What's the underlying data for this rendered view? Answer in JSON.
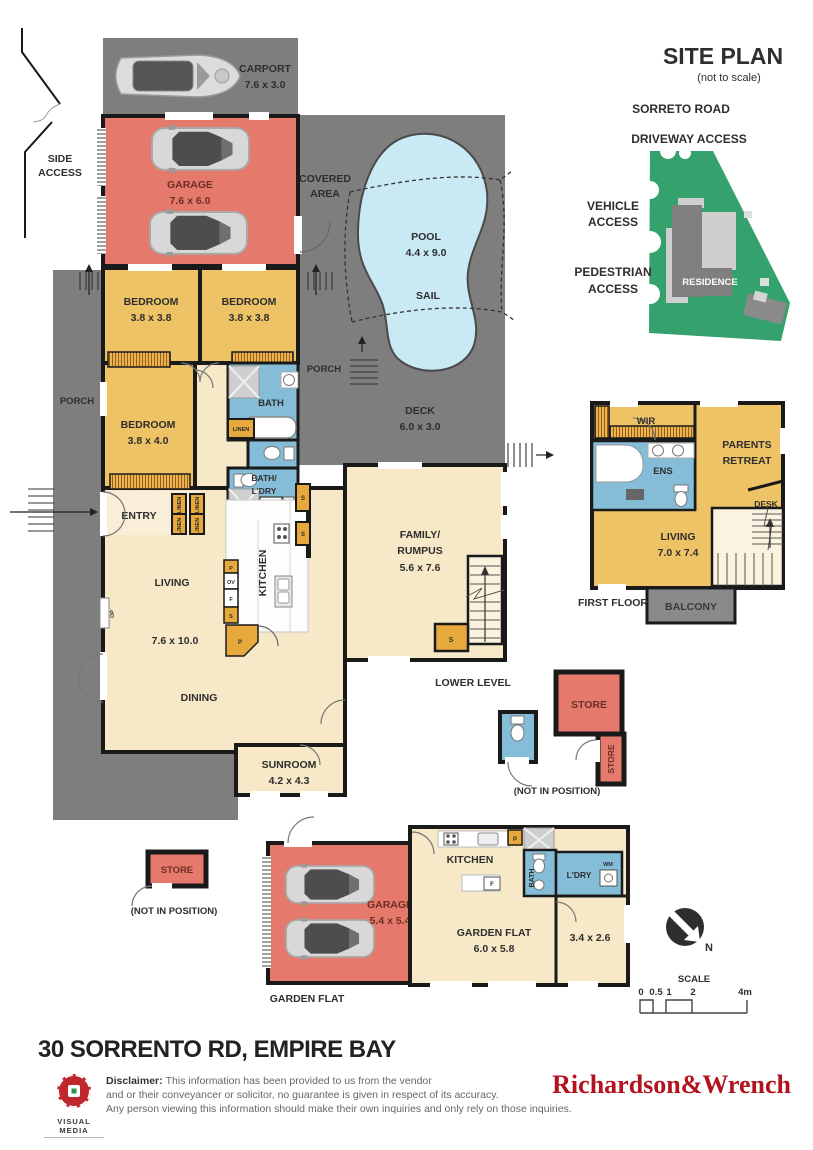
{
  "site_plan": {
    "title": "SITE PLAN",
    "subtitle": "(not to scale)",
    "road": "SORRETO ROAD",
    "driveway": "DRIVEWAY ACCESS",
    "vehicle_line1": "VEHICLE",
    "vehicle_line2": "ACCESS",
    "pedestrian_line1": "PEDESTRIAN",
    "pedestrian_line2": "ACCESS",
    "residence": "RESIDENCE"
  },
  "ground": {
    "side_access_line1": "SIDE",
    "side_access_line2": "ACCESS",
    "carport": "CARPORT",
    "carport_dims": "7.6 x 3.0",
    "garage": "GARAGE",
    "garage_dims": "7.6 x 6.0",
    "covered_line1": "COVERED",
    "covered_line2": "AREA",
    "pool": "POOL",
    "pool_dims": "4.4 x 9.0",
    "sail": "SAIL",
    "porch": "PORCH",
    "deck": "DECK",
    "deck_dims": "6.0 x 3.0",
    "bedroom": "BEDROOM",
    "bedroom12_dims": "3.8 x 3.8",
    "bedroom3_dims": "3.8 x 4.0",
    "bath": "BATH",
    "linen": "LINEN",
    "bath_ldry_line1": "BATH/",
    "bath_ldry_line2": "L'DRY",
    "wm": "WM",
    "entry": "ENTRY",
    "living": "LIVING",
    "living_dims": "7.6 x 10.0",
    "kitchen": "KITCHEN",
    "dining": "DINING",
    "family_line1": "FAMILY/",
    "family_line2": "RUMPUS",
    "family_dims": "5.6 x 7.6",
    "sunroom": "SUNROOM",
    "sunroom_dims": "4.2 x 4.3",
    "op": "OP",
    "p": "P",
    "ov": "OV",
    "f": "F",
    "s": "S"
  },
  "lower": {
    "label": "LOWER LEVEL",
    "store": "STORE",
    "not_in_position": "(NOT IN POSITION)"
  },
  "first": {
    "label": "FIRST FLOOR",
    "wir": "WIR",
    "ens": "ENS",
    "parents_line1": "PARENTS",
    "parents_line2": "RETREAT",
    "desk": "DESK",
    "living": "LIVING",
    "living_dims": "7.0 x 7.4",
    "balcony": "BALCONY"
  },
  "flat": {
    "label": "GARDEN FLAT",
    "store": "STORE",
    "not_in_position": "(NOT IN POSITION)",
    "garage": "GARAGE",
    "garage_dims": "5.4 x 5.4",
    "kitchen": "KITCHEN",
    "name": "GARDEN FLAT",
    "dims": "6.0 x 5.8",
    "room_dims": "3.4 x 2.6",
    "bath": "BATH",
    "ldry": "L'DRY",
    "wm": "WM",
    "p": "P",
    "f": "F"
  },
  "compass": {
    "n": "N"
  },
  "scale": {
    "label": "SCALE",
    "t0": "0",
    "t05": "0.5",
    "t1": "1",
    "t2": "2",
    "t4": "4m"
  },
  "footer": {
    "address": "30 SORRENTO RD, EMPIRE BAY",
    "logo": "VISUAL MEDIA",
    "disclaimer_label": "Disclaimer:",
    "disclaimer_line1": "This information has been provided to us from the vendor",
    "disclaimer_line2": "and or their conveyancer or solicitor, no guarantee is given in respect of its accuracy.",
    "disclaimer_line3": "Any person viewing this information should make their own inquiries and only rely on those inquiries.",
    "brand": "Richardson&Wrench"
  },
  "colors": {
    "outdoor_gray": "#7e7e7e",
    "garage_red": "#e5796b",
    "room_yellow": "#eec366",
    "living_cream": "#f7e9c8",
    "pool_blue": "#c9e9f4",
    "tile_blue": "#85bdd8",
    "cupboard_orange": "#e8a93c",
    "site_green": "#35a26d",
    "brand_red": "#b3121f"
  }
}
